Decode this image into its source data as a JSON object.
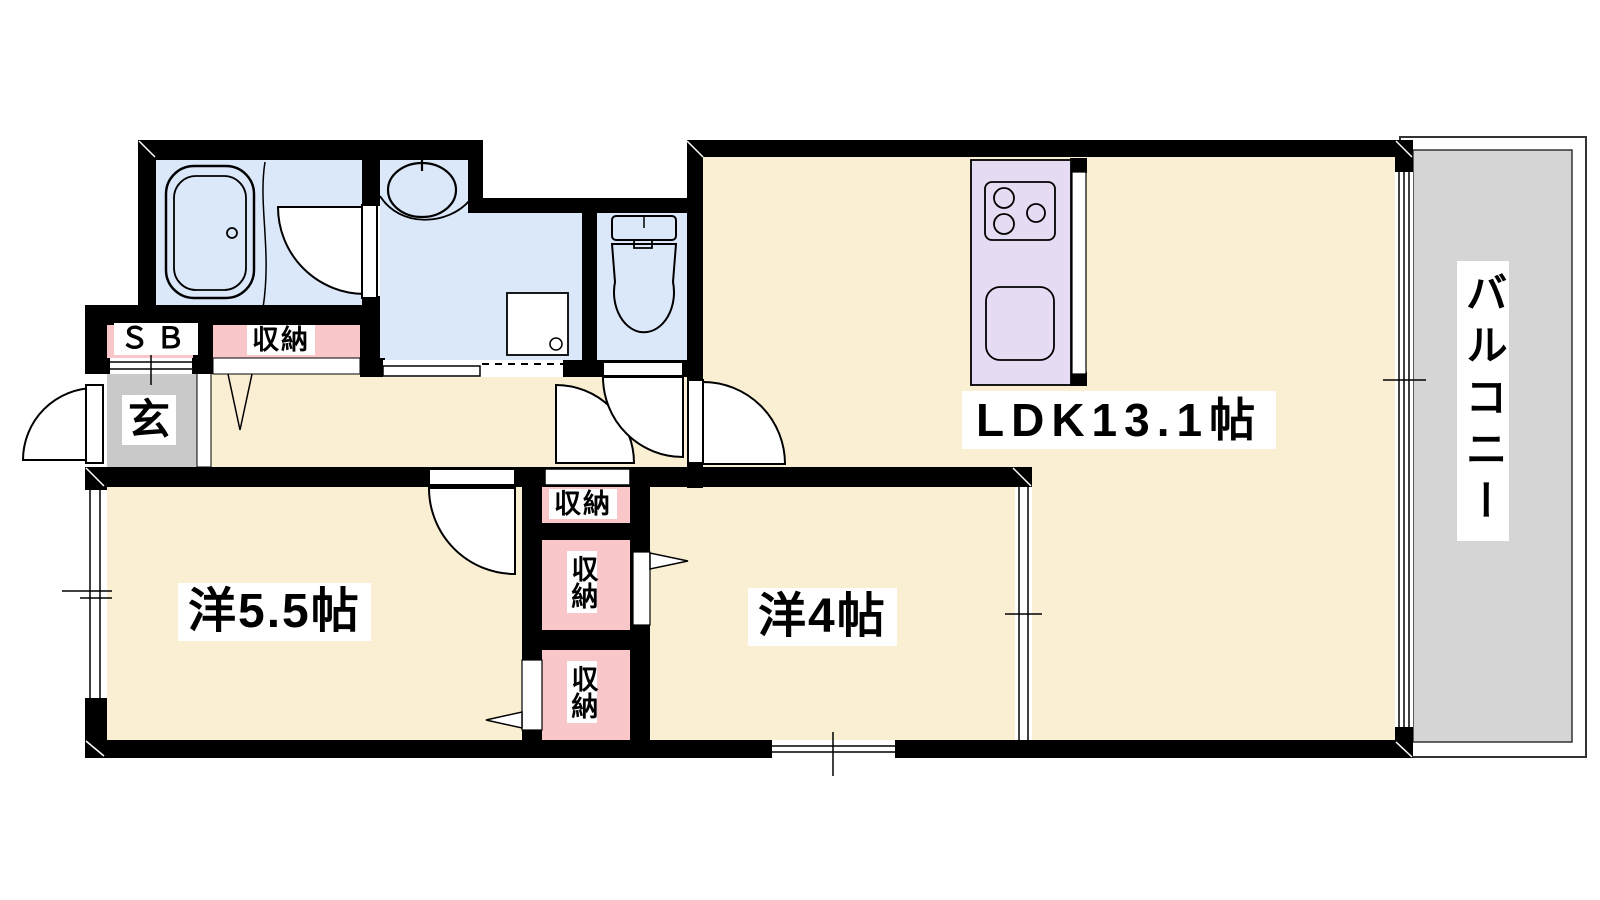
{
  "colors": {
    "wall": "#000000",
    "floor": "#FAEFD3",
    "water": "#DBE8FA",
    "pink": "#F9C6CA",
    "lavender": "#E5DBF2",
    "entrance": "#C9C9C9",
    "balcony": "#D5D5D5",
    "label": "#000000"
  },
  "rooms": {
    "ldk": {
      "label": "LDK13.1帖"
    },
    "western_5_5": {
      "label": "洋5.5帖"
    },
    "western_4": {
      "label": "洋4帖"
    },
    "balcony": {
      "label": "バルコニー"
    },
    "entrance": {
      "label": "玄"
    },
    "shoe_box": {
      "label": "ＳＢ"
    },
    "closet_hall": {
      "label": "収納"
    },
    "closet_top": {
      "label": "収納"
    },
    "closet_middle": {
      "label": "収納"
    },
    "closet_bottom": {
      "label": "収納"
    }
  }
}
